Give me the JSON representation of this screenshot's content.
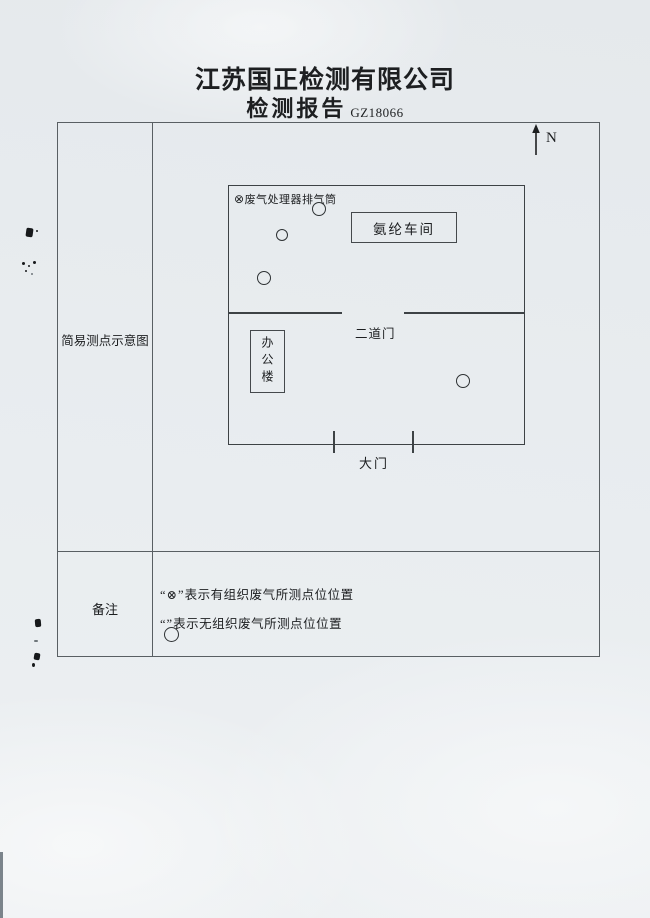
{
  "page": {
    "company": "江苏国正检测有限公司",
    "doc_type": "检测报告",
    "report_no": "GZ18066"
  },
  "table": {
    "row1_label": "简易测点示意图",
    "row2_label": "备注"
  },
  "diagram": {
    "north_label": "N",
    "stack_symbol": "⊗",
    "stack_label": "废气处理器排气筒",
    "workshop_label": "氨纶车间",
    "second_gate_label": "二道门",
    "office_label": "办公楼",
    "main_gate_label": "大门",
    "points": [
      {
        "x": 89,
        "y": 22,
        "r": 6
      },
      {
        "x": 52,
        "y": 48,
        "r": 5
      },
      {
        "x": 34,
        "y": 91,
        "r": 6
      },
      {
        "x": 233,
        "y": 194,
        "r": 6
      }
    ]
  },
  "remarks": {
    "line1_symbol": "“⊗”",
    "line1_text": "表示有组织废气所测点位位置",
    "line2_symbol": "“”",
    "line2_text": "表示无组织废气所测点位位置"
  }
}
